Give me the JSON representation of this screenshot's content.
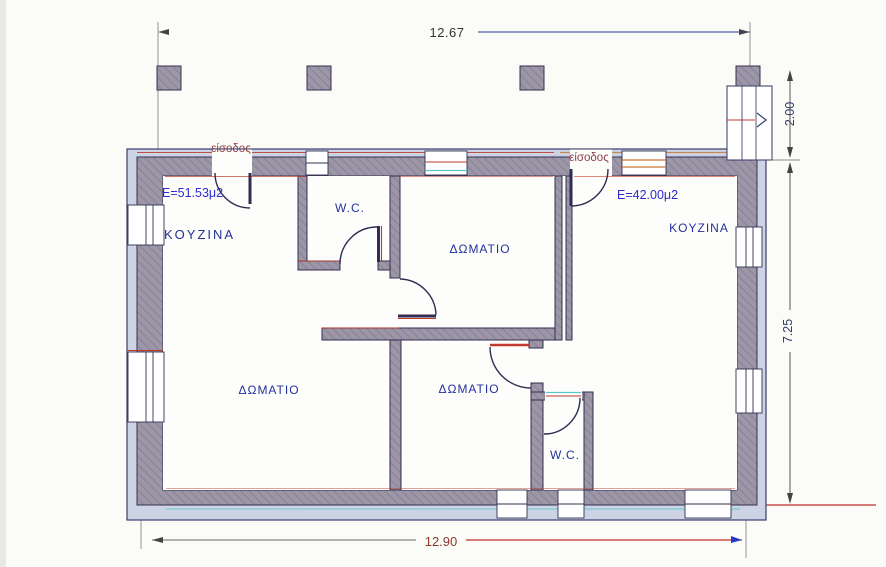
{
  "plan": {
    "dimensions": {
      "top_width": "12.67",
      "bottom_width": "12.90",
      "porch_depth": "2.00",
      "right_height": "7.25"
    },
    "apartment_left": {
      "area": "E=51.53μ2",
      "entrance": "είσοδος",
      "kitchen": "KOYZINA",
      "wc": "W.C.",
      "room_top": "ΔΩΜΑΤΙΟ",
      "room_main": "ΔΩΜΑΤΙΟ"
    },
    "apartment_right": {
      "area": "E=42.00μ2",
      "entrance": "είσοδος",
      "kitchen": "KOYZINA",
      "wc": "W.C.",
      "room": "ΔΩΜΑΤΙΟ"
    },
    "colors": {
      "wall_fill": "#9d96a7",
      "wall_outline": "#32304f",
      "outer_band": "#ccd3e5",
      "label_blue": "#23319b",
      "area_blue": "#2b2bd0",
      "entrance_maroon": "#8d4048",
      "accent_red": "#c0392b",
      "accent_cyan": "#5bc8c8",
      "accent_orange": "#c87832",
      "dim_text": "#333333",
      "dim_bottom_text": "#8a3a28"
    }
  }
}
